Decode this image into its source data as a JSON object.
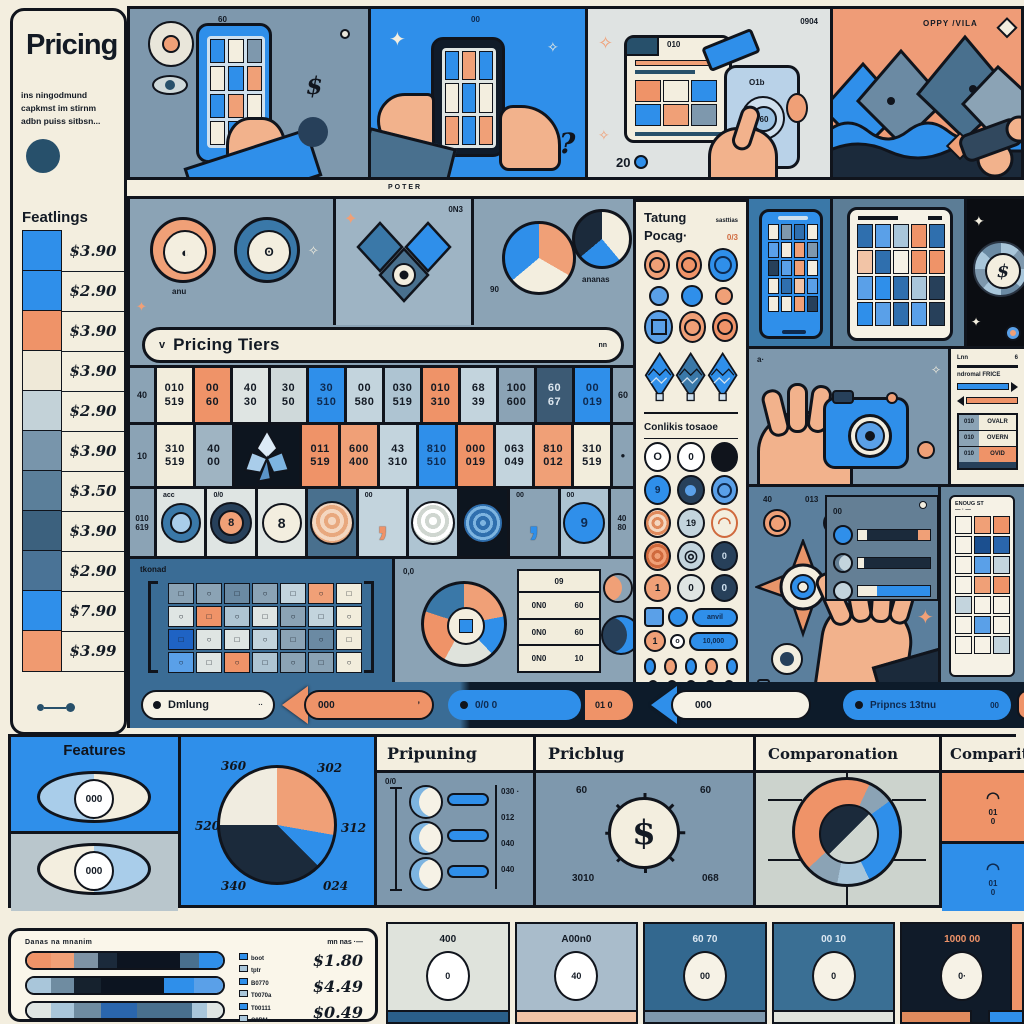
{
  "header": {
    "title": "Pricing",
    "subtitle_lines": [
      "ins ningodmund",
      "capkmst im stirnm",
      "adbn puiss sitbsn..."
    ],
    "features_header": "Featlings",
    "poster_label": "POTER"
  },
  "sidebar_prices": [
    {
      "color": "#2f8fea",
      "value": "$3.90"
    },
    {
      "color": "#2f8fea",
      "value": "$2.90"
    },
    {
      "color": "#ef9368",
      "value": "$3.90"
    },
    {
      "color": "#efe9d8",
      "value": "$3.90"
    },
    {
      "color": "#c3d2d8",
      "value": "$2.90"
    },
    {
      "color": "#7895ab",
      "value": "$3.90"
    },
    {
      "color": "#5b7f9a",
      "value": "$3.50"
    },
    {
      "color": "#3c617e",
      "value": "$3.90"
    },
    {
      "color": "#4a7396",
      "value": "$2.90"
    },
    {
      "color": "#2f8fea",
      "value": "$7.90"
    },
    {
      "color": "#f09a70",
      "value": "$3.99"
    }
  ],
  "top_strip": {
    "panel1": {
      "label": "60",
      "dollar": "$"
    },
    "panel2": {
      "label": "00",
      "question": "?"
    },
    "panel3": {
      "corner_label": "0904",
      "tab_label": "010",
      "badge1": "O1b",
      "badge2": "60",
      "bottom_left": "20"
    },
    "panel4": {
      "label": "OPPY /VILA"
    }
  },
  "icons_row": {
    "donut1_label": "anu",
    "diamond_label": "0N3",
    "pie1_label": "90",
    "pie2_label": "ananas"
  },
  "tier_banner": {
    "chevron": "v",
    "label": "Pricing Tiers",
    "right": "nn"
  },
  "tier_grid": {
    "row1_left": "40",
    "row1_right": "60",
    "row1": [
      {
        "top": "010",
        "bottom": "519"
      },
      {
        "top": "00",
        "bottom": "60"
      },
      {
        "top": "40",
        "bottom": "30"
      },
      {
        "top": "30",
        "bottom": "50"
      },
      {
        "top": "30",
        "bottom": "510"
      },
      {
        "top": "00",
        "bottom": "580"
      },
      {
        "top": "030",
        "bottom": "519"
      },
      {
        "top": "010",
        "bottom": "310"
      },
      {
        "top": "68",
        "bottom": "39"
      },
      {
        "top": "100",
        "bottom": "600"
      },
      {
        "top": "60",
        "bottom": "67"
      },
      {
        "top": "00",
        "bottom": "019"
      }
    ],
    "row2_left": "10",
    "row2_right": "●",
    "row2": [
      {
        "top": "310",
        "bottom": "519"
      },
      {
        "top": "40",
        "bottom": "00"
      },
      {
        "top": "011",
        "bottom": "519"
      },
      {
        "top": "600",
        "bottom": "400"
      },
      {
        "top": "43",
        "bottom": "310"
      },
      {
        "top": "810",
        "bottom": "510"
      },
      {
        "top": "000",
        "bottom": "019"
      },
      {
        "top": "063",
        "bottom": "049"
      },
      {
        "top": "810",
        "bottom": "012"
      },
      {
        "top": "310",
        "bottom": "519"
      }
    ],
    "coins_left_top": "010",
    "coins_left_bottom": "619",
    "coins_right_top": "40",
    "coins_right_bottom": "80",
    "coin_labels": [
      "acc",
      "0/0",
      "",
      "",
      "00",
      "",
      "",
      "00",
      "00"
    ],
    "eight": "8"
  },
  "matrix_panel": {
    "label": "tkonad"
  },
  "puzzle_panel": {
    "label": "0,0",
    "table_header": "09",
    "table_rows": [
      [
        "0N0",
        "60"
      ],
      [
        "0N0",
        "60"
      ],
      [
        "0N0",
        "10"
      ]
    ]
  },
  "package_panel": {
    "header1": "Tatung",
    "header1_right": "sasttias",
    "header2": "Pocag·",
    "header2_right": "0/3",
    "section_header": "Conlikis tosaoe",
    "coin_texts": {
      "c1": "O",
      "c2": "0",
      "c6": "19",
      "c9": "0",
      "c10": "1",
      "c11": "0",
      "c12": "0"
    },
    "pill1_label": "anvil",
    "pill2_label": "10,000",
    "button_left": "Lao",
    "button_right": "mma"
  },
  "right_side": {
    "wheel_dollar": "$",
    "sliders": {
      "row1_label": "Lnn",
      "row2_label": "ndromal FRICE"
    },
    "mini_table": [
      {
        "key": "010",
        "value": "OVALR"
      },
      {
        "key": "010",
        "value": "OVERN"
      },
      {
        "key": "010",
        "value": "OVID"
      }
    ],
    "compass": {
      "label1": "40",
      "label2": "013",
      "dollar": "$"
    },
    "list_card_label": "00",
    "grid_card_header": "ENOUG ST"
  },
  "nav": {
    "pill1": {
      "label": "Dmlung",
      "right": "··"
    },
    "pill2": {
      "label": "000",
      "right": "’"
    },
    "pill3": {
      "label": "0/0 0"
    },
    "pill4": {
      "label": "01 0"
    },
    "pill5": {
      "label": "000"
    },
    "pill6": {
      "label": "Pripncs 13tnu",
      "right": "00"
    }
  },
  "bottom_panels": {
    "features": {
      "title": "Features",
      "eye1": "000",
      "eye2": "000"
    },
    "pie": {
      "l_tl": "360",
      "l_tr": "302",
      "l_l": "520",
      "l_r": "312",
      "l_bl": "340",
      "l_br": "024"
    },
    "pripuning": {
      "title": "Pripuning",
      "axis": "0/0",
      "t1": "030 ·",
      "t2": "012",
      "t3": "040",
      "t4": "040"
    },
    "pricblug": {
      "title": "Pricblug",
      "dollar": "$",
      "l_tl": "60",
      "l_tr": "60",
      "l_bl": "3010",
      "l_br": "068"
    },
    "comparonation": {
      "title": "Comparonation"
    },
    "comparital": {
      "title": "Comparital",
      "cell1_num": "01",
      "cell1_sub": "0",
      "cell2_num": "01",
      "cell2_sub": "0",
      "label1": "01",
      "label2": "0.0"
    }
  },
  "bottom_strip": {
    "card_title": "Danas na mnanim",
    "card_title_right": "mn nas ·—",
    "legend": [
      {
        "line1": "boot",
        "line2": "tptr",
        "price": "$1.80"
      },
      {
        "line1": "B0770",
        "line2": "T0070a",
        "price": "$4.49"
      },
      {
        "line1": "T00111",
        "line2": "C9PM",
        "price": "$0.49"
      }
    ],
    "cards": [
      {
        "label": "400",
        "oval": "0"
      },
      {
        "label": "A00n0",
        "oval": "40"
      },
      {
        "label": "60 70",
        "oval": "00"
      },
      {
        "label": "00 10",
        "oval": "0"
      },
      {
        "label": "1000 00",
        "oval": "0·"
      }
    ]
  }
}
